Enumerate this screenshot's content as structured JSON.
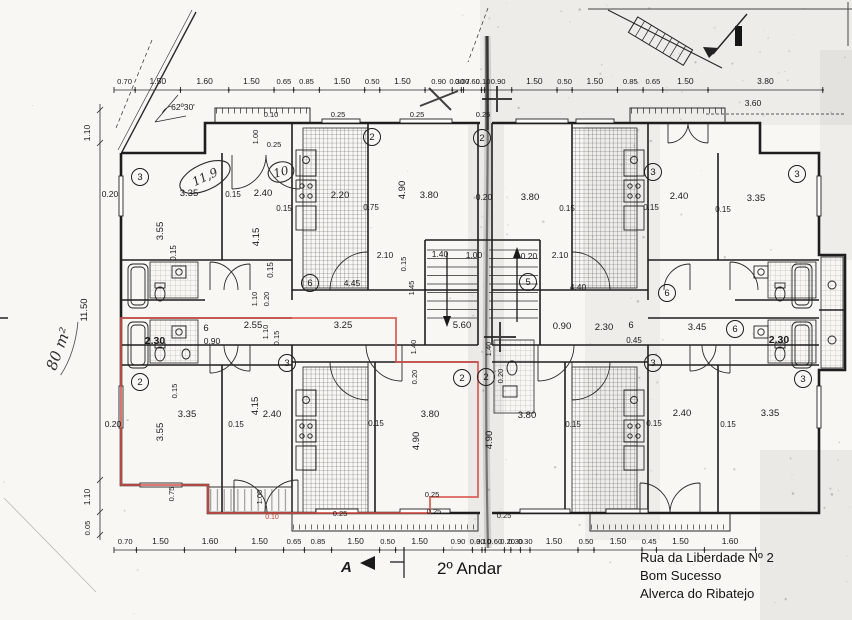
{
  "texts": {
    "floor_title": "2º Andar",
    "address_line1": "Rua da Liberdade Nº 2",
    "address_line2": "Bom Sucesso",
    "address_line3": "Alverca do Ribatejo",
    "area_note": "80 m²",
    "section_letter": "A"
  },
  "colors": {
    "highlight": "#d8534a",
    "ink": "#1c1c1c",
    "paper": "#f8f7f4"
  },
  "dim_chains": [
    {
      "y": 90,
      "x0": 114,
      "scale": 30.2,
      "values": [
        "0.70",
        "1.50",
        "1.60",
        "1.50",
        "0.65",
        "0.85",
        "1.50",
        "0.50",
        "1.50",
        "0.90",
        "0.30",
        "0.07",
        "0.60",
        "0.10",
        "0.90",
        "1.50",
        "0.50",
        "1.50",
        "0.85",
        "0.65",
        "1.50",
        "3.80"
      ]
    },
    {
      "y": 550,
      "x0": 114,
      "scale": 32,
      "values": [
        "0.70",
        "1.50",
        "1.60",
        "1.50",
        "0.65",
        "0.85",
        "1.50",
        "0.50",
        "1.50",
        "0.90",
        "0.30",
        "0.10",
        "0.60",
        "0.20",
        "0.30",
        "0.30",
        "1.50",
        "0.50",
        "1.50",
        "0.45",
        "1.50",
        "1.60"
      ]
    }
  ],
  "plan_labels": [
    [
      "0.10",
      271,
      117,
      0,
      7.5,
      ""
    ],
    [
      "0.25",
      274,
      147,
      0,
      7.5,
      ""
    ],
    [
      "0.25",
      338,
      117,
      0,
      7.5,
      ""
    ],
    [
      "0.25",
      417,
      117,
      0,
      7.5,
      ""
    ],
    [
      "0.25",
      483,
      117,
      0,
      7.5,
      ""
    ],
    [
      "1.00",
      258,
      137,
      -90,
      7.5,
      ""
    ],
    [
      "62º30'",
      183,
      110,
      0,
      8.5,
      ""
    ],
    [
      "1.10",
      90,
      133,
      -90,
      8.5,
      ""
    ],
    [
      "3.60",
      753,
      106,
      0,
      8.5,
      ""
    ],
    [
      "0.20",
      110,
      197,
      0,
      8.5,
      ""
    ],
    [
      "3.35",
      189,
      196,
      0,
      9.5,
      ""
    ],
    [
      "0.15",
      233,
      197,
      0,
      8,
      ""
    ],
    [
      "2.40",
      263,
      196,
      0,
      9.5,
      ""
    ],
    [
      "0.15",
      284,
      211,
      0,
      8,
      ""
    ],
    [
      "3.55",
      163,
      231,
      -90,
      9.5,
      ""
    ],
    [
      "4.15",
      259,
      237,
      -90,
      9.5,
      ""
    ],
    [
      "0.15",
      176,
      253,
      -90,
      8,
      ""
    ],
    [
      "0.15",
      273,
      270,
      -90,
      8,
      ""
    ],
    [
      "2.20",
      340,
      198,
      0,
      9.5,
      ""
    ],
    [
      "0.75",
      371,
      210,
      0,
      8,
      ""
    ],
    [
      "4.90",
      405,
      190,
      -90,
      9.5,
      ""
    ],
    [
      "3.80",
      429,
      198,
      0,
      9.5,
      ""
    ],
    [
      "0.20",
      484,
      200,
      0,
      8.5,
      ""
    ],
    [
      "3.80",
      530,
      200,
      0,
      9.5,
      ""
    ],
    [
      "0.15",
      567,
      211,
      0,
      8,
      ""
    ],
    [
      "2.40",
      679,
      199,
      0,
      9.5,
      ""
    ],
    [
      "0.15",
      651,
      210,
      0,
      8,
      ""
    ],
    [
      "0.15",
      723,
      212,
      0,
      8,
      ""
    ],
    [
      "3.35",
      756,
      201,
      0,
      9.5,
      ""
    ],
    [
      "2.10",
      385,
      258,
      0,
      8.5,
      ""
    ],
    [
      "1.40",
      440,
      257,
      0,
      8.5,
      ""
    ],
    [
      "1.00",
      474,
      258,
      0,
      8.5,
      ""
    ],
    [
      "0.20",
      529,
      259,
      0,
      8.5,
      ""
    ],
    [
      "2.10",
      560,
      258,
      0,
      8.5,
      ""
    ],
    [
      "0.15",
      406,
      264,
      -90,
      7.5,
      ""
    ],
    [
      "4.45",
      352,
      286,
      0,
      8.5,
      ""
    ],
    [
      "1.45",
      414,
      288,
      -90,
      7.5,
      ""
    ],
    [
      "4.40",
      578,
      290,
      0,
      8.5,
      ""
    ],
    [
      "1.10",
      257,
      299,
      -90,
      7.5,
      ""
    ],
    [
      "0.20",
      269,
      299,
      -90,
      7.5,
      ""
    ],
    [
      "6",
      206,
      331,
      0,
      9.5,
      ""
    ],
    [
      "2.55",
      253,
      328,
      0,
      9.5,
      ""
    ],
    [
      "0.90",
      212,
      344,
      0,
      8.5,
      ""
    ],
    [
      "2.30",
      155,
      344,
      0,
      10.5,
      "b"
    ],
    [
      "0.15",
      279,
      338,
      -90,
      7.5,
      ""
    ],
    [
      "1.10",
      268,
      332,
      -90,
      7.5,
      ""
    ],
    [
      "3.25",
      343,
      328,
      0,
      9.5,
      ""
    ],
    [
      "5.60",
      462,
      328,
      0,
      9.5,
      ""
    ],
    [
      "0.90",
      562,
      329,
      0,
      9.5,
      ""
    ],
    [
      "2.30",
      604,
      330,
      0,
      9.5,
      ""
    ],
    [
      "6",
      631,
      328,
      0,
      9.5,
      ""
    ],
    [
      "3.45",
      697,
      330,
      0,
      9.5,
      ""
    ],
    [
      "0.45",
      634,
      343,
      0,
      8,
      ""
    ],
    [
      "2.30",
      779,
      343,
      0,
      10.5,
      "b"
    ],
    [
      "1.40",
      416,
      347,
      -90,
      7.5,
      ""
    ],
    [
      "1.40",
      491,
      349,
      -90,
      7.5,
      ""
    ],
    [
      "0.20",
      417,
      377,
      -90,
      7.5,
      ""
    ],
    [
      "0.20",
      503,
      376,
      -90,
      7.5,
      ""
    ],
    [
      "0.20",
      113,
      427,
      0,
      8.5,
      ""
    ],
    [
      "3.55",
      163,
      432,
      -90,
      9.5,
      ""
    ],
    [
      "3.35",
      187,
      417,
      0,
      9.5,
      ""
    ],
    [
      "0.15",
      177,
      391,
      -90,
      7.5,
      ""
    ],
    [
      "4.15",
      258,
      406,
      -90,
      9.5,
      ""
    ],
    [
      "2.40",
      272,
      417,
      0,
      9.5,
      ""
    ],
    [
      "0.15",
      236,
      427,
      0,
      8,
      ""
    ],
    [
      "3.80",
      430,
      417,
      0,
      9.5,
      ""
    ],
    [
      "4.90",
      419,
      441,
      -90,
      9.5,
      ""
    ],
    [
      "0.15",
      376,
      426,
      0,
      8,
      ""
    ],
    [
      "3.80",
      527,
      418,
      0,
      9.5,
      ""
    ],
    [
      "4.90",
      492,
      440,
      -90,
      9.5,
      ""
    ],
    [
      "0.15",
      573,
      427,
      0,
      8,
      ""
    ],
    [
      "2.40",
      682,
      416,
      0,
      9.5,
      ""
    ],
    [
      "3.35",
      770,
      416,
      0,
      9.5,
      ""
    ],
    [
      "0.15",
      654,
      426,
      0,
      8,
      ""
    ],
    [
      "0.15",
      728,
      427,
      0,
      8,
      ""
    ],
    [
      "0.25",
      340,
      516,
      0,
      7.5,
      ""
    ],
    [
      "0.25",
      432,
      497,
      0,
      7.5,
      ""
    ],
    [
      "0.25",
      434,
      514,
      0,
      7.5,
      ""
    ],
    [
      "0.25",
      504,
      518,
      0,
      7.5,
      ""
    ],
    [
      "1.00",
      262,
      497,
      -90,
      7.5,
      ""
    ],
    [
      "0.75",
      174,
      494,
      -90,
      7.5,
      ""
    ],
    [
      "1.10",
      90,
      497,
      -90,
      8.5,
      ""
    ],
    [
      "0.05",
      90,
      528,
      -90,
      7.5,
      ""
    ],
    [
      "11.50",
      87,
      310,
      -90,
      9.5,
      ""
    ],
    [
      "0.10",
      272,
      519,
      0,
      7,
      "r"
    ]
  ],
  "circled_numbers": [
    [
      "3",
      140,
      177
    ],
    [
      "2",
      372,
      137
    ],
    [
      "2",
      482,
      138
    ],
    [
      "3",
      653,
      172
    ],
    [
      "3",
      797,
      174
    ],
    [
      "6",
      310,
      283
    ],
    [
      "5",
      528,
      282
    ],
    [
      "6",
      667,
      293
    ],
    [
      "6",
      735,
      329
    ],
    [
      "2",
      140,
      382
    ],
    [
      "3",
      287,
      363
    ],
    [
      "2",
      462,
      378
    ],
    [
      "2",
      486,
      377
    ],
    [
      "3",
      653,
      363
    ],
    [
      "3",
      803,
      379
    ]
  ],
  "handwritten_ellipses": [
    {
      "t": "11,9",
      "x": 205,
      "y": 177,
      "rot": -25,
      "rx": 27,
      "ry": 13
    },
    {
      "t": "10",
      "x": 281,
      "y": 172,
      "rot": -15,
      "rx": 13,
      "ry": 10
    }
  ]
}
